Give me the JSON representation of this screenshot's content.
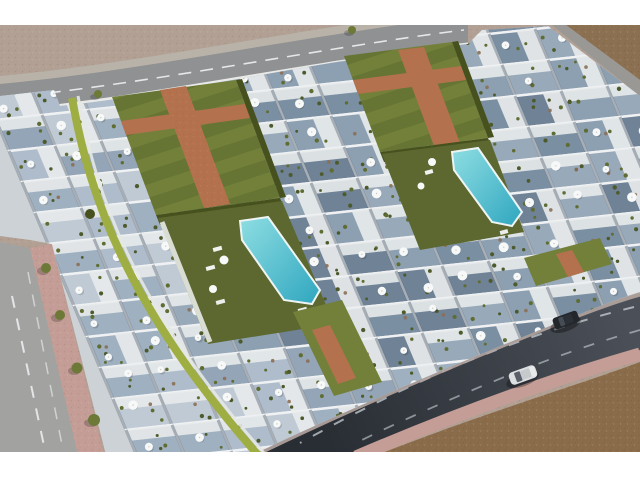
{
  "meta": {
    "description": "Aerial 3D architectural rendering of a modern white townhouse complex with rooftop terraces and parasols, two lawn courtyards with cross-shaped brick paths, two turquoise swimming pools, perimeter roads, and two cars on a curved asphalt road; undeveloped sandy ground at the edges; white letterbox bars above and below the photo.",
    "image_type": "architectural-visualization-photo",
    "visible_text": ""
  },
  "palette": {
    "letterbox": "#ffffff",
    "sand": "#b1a093",
    "sandDot": "#9c8b7c",
    "dirt": "#8c7052",
    "dirt2": "#8a6c4a",
    "roadTop": "#8f9193",
    "sidewalkTop": "#b8b2a9",
    "roadLeft": "#a2a3a1",
    "roadStripRight": "#9a9894",
    "sidewalkPink": "#c49d96",
    "wallPink": "#b4a5a0",
    "asphalt": "#4b5058",
    "marking": "#eef1f3",
    "concrete": "#cdd2d6",
    "wallBlue": "#9db0c2",
    "wallWhite": "#e9eae8",
    "lawn": "#72803a",
    "lawnDark": "#5c682f",
    "hedge": "#46511e",
    "lime": "#9fae42",
    "brick": "#b4714d",
    "poolLight": "#8edee2",
    "poolDeep": "#2fa6bf",
    "poolCoping": "#eef4f4",
    "carDark": "#23272c",
    "carSilver": "#dcdfe1",
    "tree": "#6d7937",
    "plant": "#4d5a2b",
    "umbrella": "#f7f8f8",
    "furniture": "#8a6f55"
  },
  "housing": {
    "seed": 7,
    "grid": {
      "cols": 18,
      "rows": 14,
      "origin": [
        -30,
        58
      ],
      "v_axis": [
        46,
        -5
      ],
      "u_axis": [
        13,
        31
      ]
    },
    "unit_fills": [
      "#8da0b2",
      "#7b8fa3",
      "#98a9ba",
      "#6f8296"
    ],
    "unit_fills_light": [
      "#aebccb",
      "#9fb0c0",
      "#c0cad4",
      "#93a5b6"
    ],
    "roof_white": "#e7eaeb",
    "wall_stroke": "#eff1f3",
    "umbrella_probability": 0.65,
    "furniture_probability": 0.45
  },
  "scene_objects": {
    "courtyards": 2,
    "cross_brick_paths": 2,
    "swimming_pools": 2,
    "vehicles": [
      {
        "type": "suv",
        "color_name": "dark"
      },
      {
        "type": "sedan",
        "color_name": "silver"
      }
    ],
    "street_trees": 6,
    "shrubs": 1,
    "rooftop_terraces_feature": "white parasols, plants, loungers"
  }
}
